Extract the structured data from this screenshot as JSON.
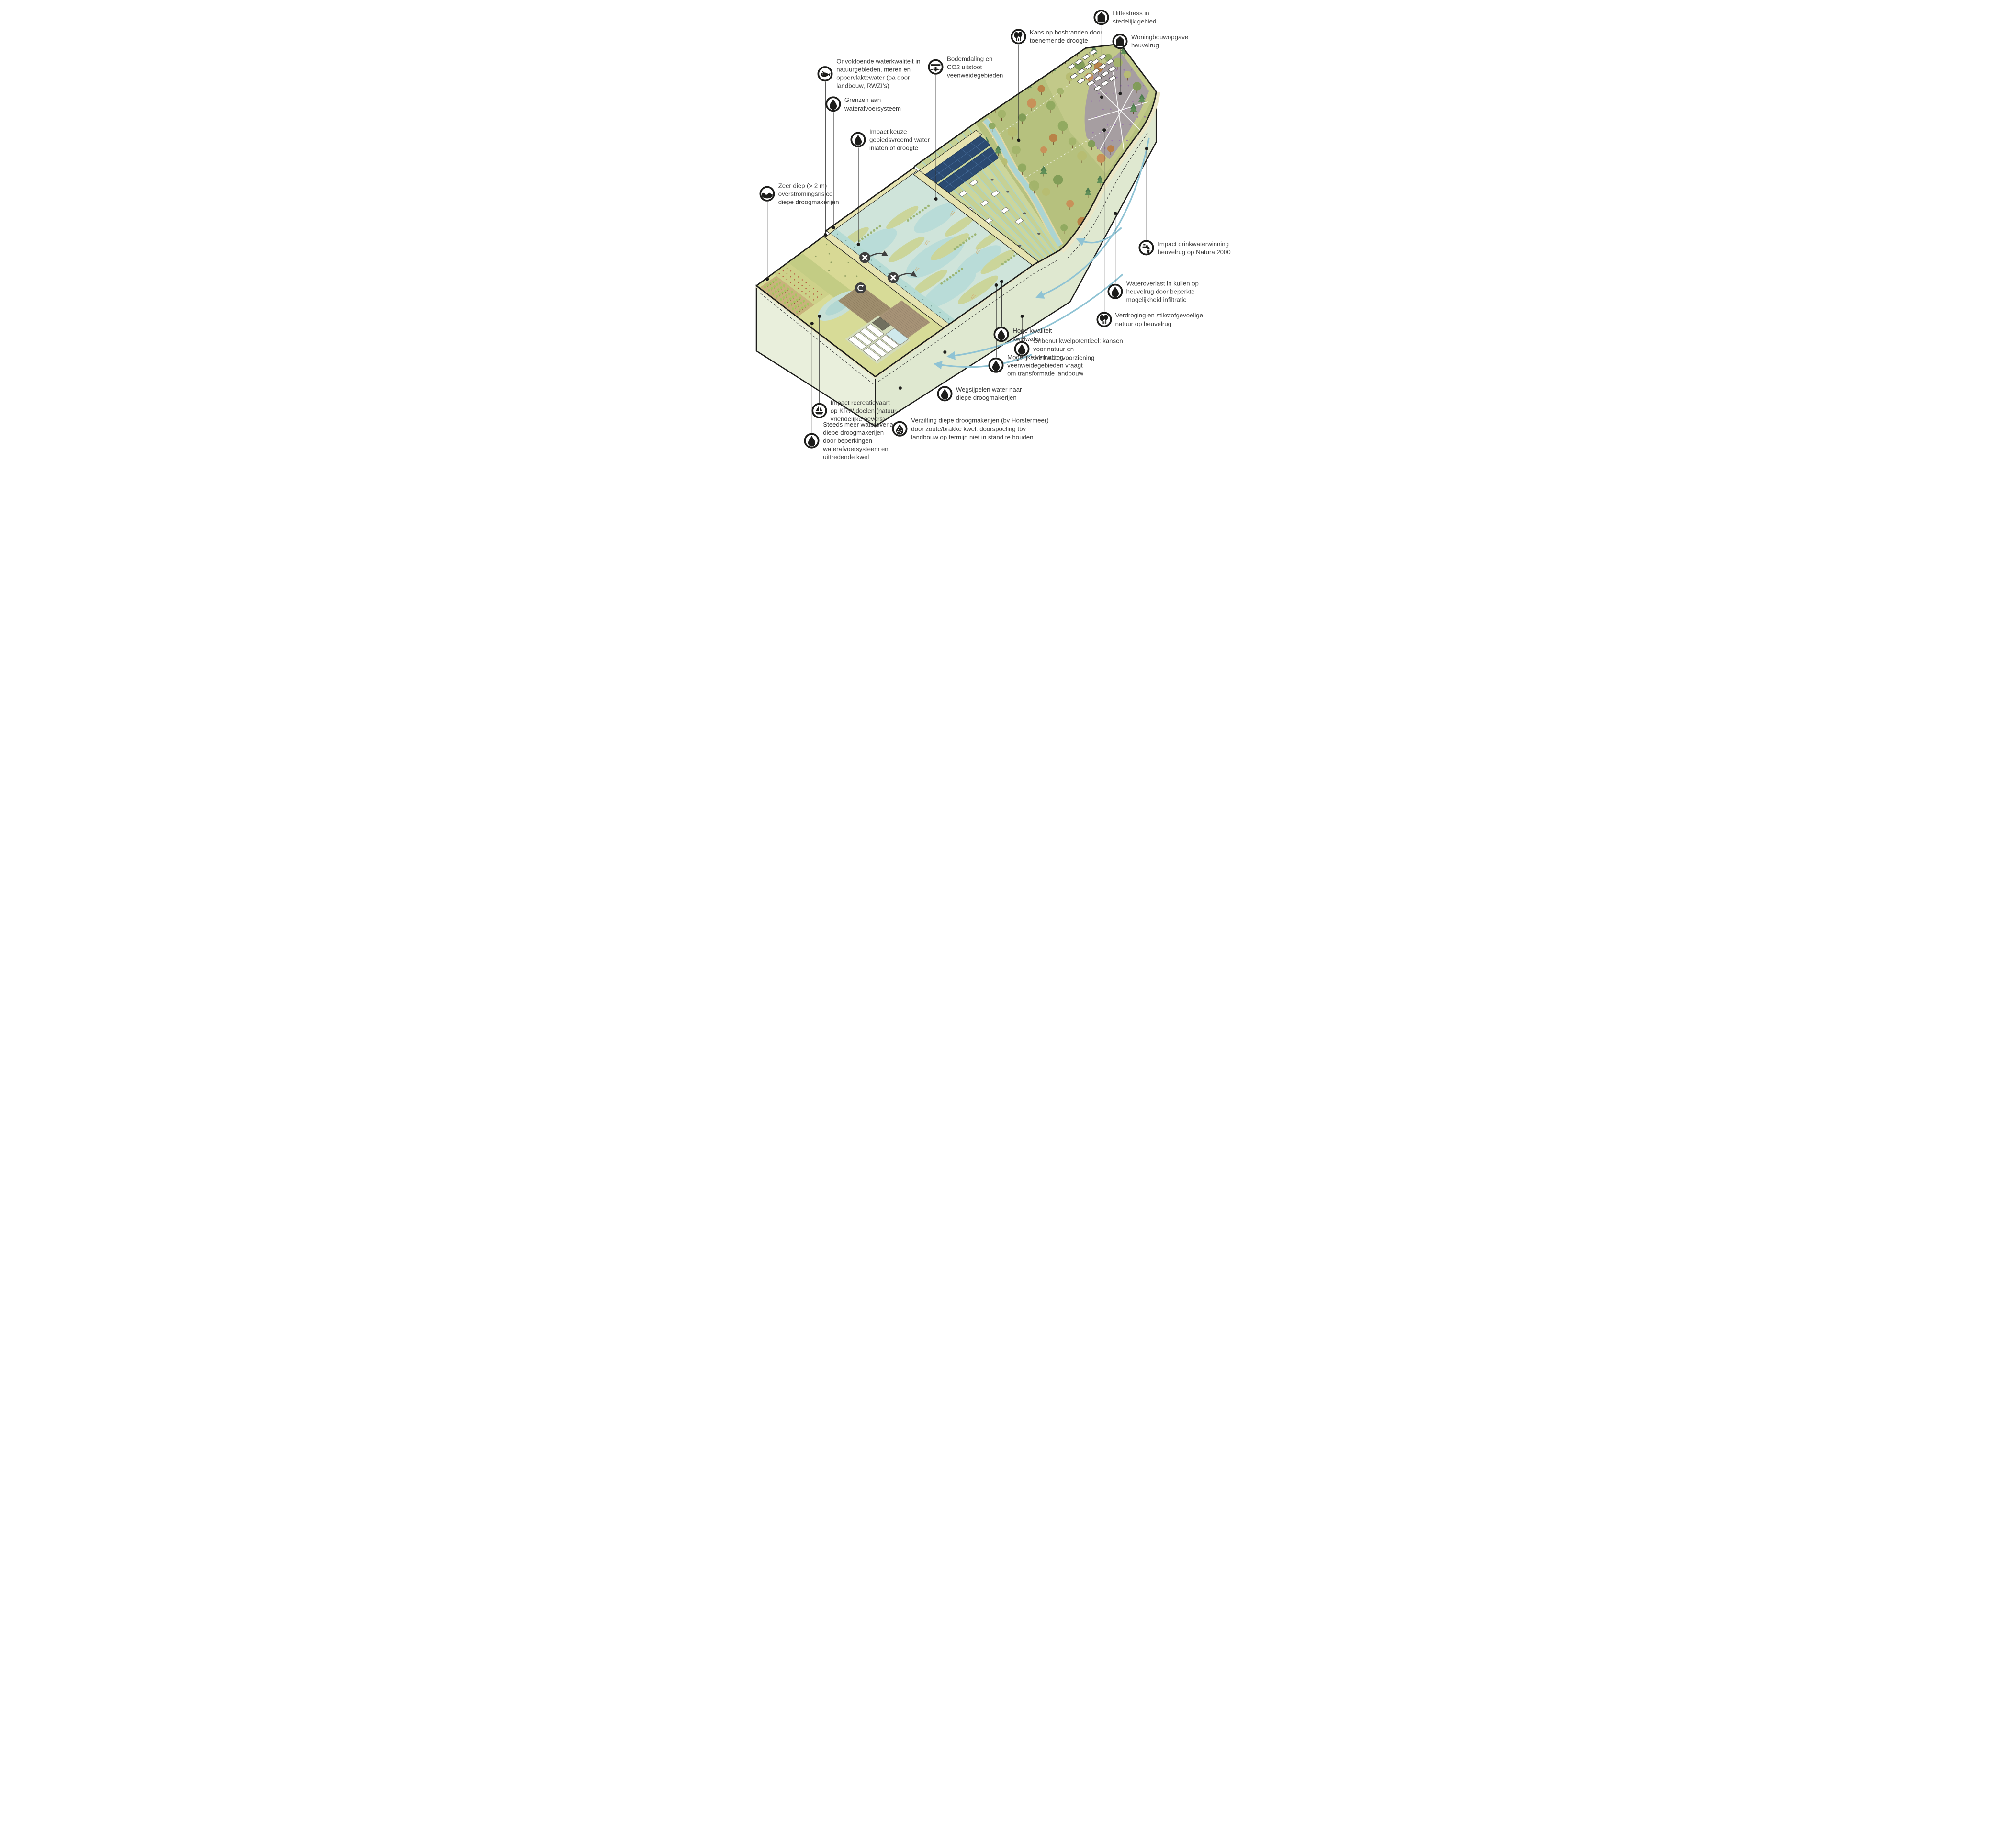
{
  "title": "Watersysteem knelpunten doorsnede (droogmakerijen - veenweide - heuvelrug)",
  "colors": {
    "background": "#ffffff",
    "outline": "#1d1d1b",
    "text": "#3c3c3c",
    "underground": "#e3ebd5",
    "wetland_water": "#cfe4da",
    "polder_green": "#d7db97",
    "veenweide_green": "#c6d194",
    "forest_green": "#b6c17e",
    "heather": "#a49aa3",
    "solar_panel": "#2b4a71",
    "groundwater_arrow": "#8fc3d4",
    "dike_cream": "#e6e3b0"
  },
  "terrain_markers": [
    "no-discharge-icon",
    "no-discharge-icon",
    "recirculation-icon"
  ],
  "labels": [
    {
      "id": "hittestress",
      "icon": "house-icon",
      "lines": [
        "Hittestress in",
        "stedelijk gebied"
      ]
    },
    {
      "id": "bosbranden",
      "icon": "trees-icon",
      "lines": [
        "Kans op bosbranden door",
        "toenemende droogte"
      ]
    },
    {
      "id": "woningbouw",
      "icon": "house-icon",
      "lines": [
        "Woningbouwopgave",
        "heuvelrug"
      ]
    },
    {
      "id": "bodemdaling",
      "icon": "subsidence-icon",
      "lines": [
        "Bodemdaling en",
        "CO2 uitstoot",
        "veenweidegebieden"
      ]
    },
    {
      "id": "waterkwaliteit",
      "icon": "fish-icon",
      "lines": [
        "Onvoldoende waterkwaliteit in",
        "natuurgebieden, meren  en",
        "oppervlaktewater (oa door",
        "landbouw, RWZI’s)"
      ]
    },
    {
      "id": "grenzen",
      "icon": "droplet-icon",
      "lines": [
        "Grenzen aan",
        "waterafvoersysteem"
      ]
    },
    {
      "id": "gebiedsvreemd",
      "icon": "droplet-icon",
      "lines": [
        "Impact keuze",
        "gebiedsvreemd water",
        "inlaten of droogte"
      ]
    },
    {
      "id": "zeer-diep",
      "icon": "wave-icon",
      "lines": [
        "Zeer diep (> 2 m)",
        "overstromingsrisico",
        "diepe droogmakerijen"
      ]
    },
    {
      "id": "drinkwaterwinning",
      "icon": "tap-icon",
      "lines": [
        "Impact drinkwaterwinning",
        "heuvelrug op Natura 2000"
      ]
    },
    {
      "id": "wateroverlast-kuilen",
      "icon": "droplet-icon",
      "lines": [
        "Wateroverlast in kuilen op",
        "heuvelrug door beperkte",
        "mogelijkheid infiltratie"
      ]
    },
    {
      "id": "verdroging",
      "icon": "trees-icon",
      "lines": [
        "Verdroging en stikstofgevoelige",
        "natuur op heuvelrug"
      ]
    },
    {
      "id": "hoge-kwaliteit",
      "icon": "droplet-icon",
      "lines": [
        "Hoge kwaliteit",
        "kwelwater"
      ]
    },
    {
      "id": "onbenut-kwelpotentieel",
      "icon": "droplet-icon",
      "lines": [
        "Onbenut kwelpotentieel: kansen",
        "voor natuur en",
        "drinkwatervoorziening"
      ]
    },
    {
      "id": "vernatting",
      "icon": "droplet-icon",
      "lines": [
        "Mogelijke vernatting",
        "veenweidegebieden vraagt",
        "om transformatie landbouw"
      ]
    },
    {
      "id": "wegsijpelen",
      "icon": "droplet-icon",
      "lines": [
        "Wegsijpelen water naar",
        "diepe droogmakerijen"
      ]
    },
    {
      "id": "recreatievaart",
      "icon": "boat-icon",
      "lines": [
        "Impact recreatievaart",
        "op KRW doelen (natuur-",
        "vriendelijke oevers)"
      ]
    },
    {
      "id": "steeds-meer-wateroverlast",
      "icon": "droplet-icon",
      "lines": [
        "Steeds meer wateroverlast",
        "diepe droogmakerijen",
        "door beperkingen",
        "waterafvoersysteem en",
        "uittredende kwel"
      ]
    },
    {
      "id": "verzilting",
      "icon": "salt-droplet-icon",
      "lines": [
        "Verzilting diepe droogmakerijen (bv Horstermeer)",
        "door zoute/brakke kwel: doorspoeling tbv",
        "landbouw op termijn niet in stand te houden"
      ]
    }
  ]
}
